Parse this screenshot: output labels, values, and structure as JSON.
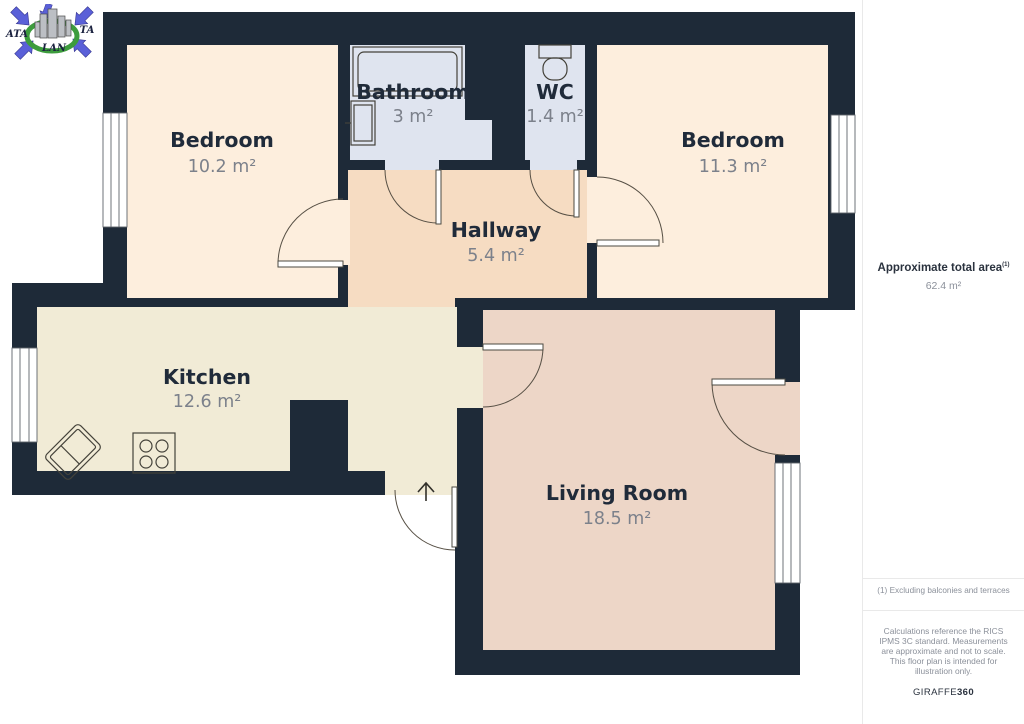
{
  "logo": {
    "left": "ATA",
    "right": "TA",
    "bottom": "LAN"
  },
  "rooms": [
    {
      "name": "Bedroom",
      "area": "10.2 m²"
    },
    {
      "name": "Bathroom",
      "area": "3 m²"
    },
    {
      "name": "WC",
      "area": "1.4 m²"
    },
    {
      "name": "Bedroom",
      "area": "11.3 m²"
    },
    {
      "name": "Hallway",
      "area": "5.4 m²"
    },
    {
      "name": "Kitchen",
      "area": "12.6 m²"
    },
    {
      "name": "Living Room",
      "area": "18.5 m²"
    }
  ],
  "sidebar": {
    "total_area_label": "Approximate total area",
    "total_area_sup": "(1)",
    "total_area_value": "62.4 m²",
    "footnote": "(1) Excluding balconies and terraces",
    "disclaimer": "Calculations reference the RICS IPMS 3C standard. Measurements are approximate and not to scale. This floor plan is intended for illustration only.",
    "brand_name": "GIRAFFE",
    "brand_suffix": "360"
  },
  "colors": {
    "wall": "#1e2a38",
    "bedroom": "#fdeedd",
    "hallway": "#f6dcc2",
    "kitchen": "#f1ebd6",
    "living_room": "#edd6c7",
    "bathroom_wc": "#dfe4ef",
    "logo_arrow": "#5a60d8",
    "logo_ring": "#3d9c3d",
    "room_label": "#202b3a",
    "area_label": "#7c818b"
  }
}
